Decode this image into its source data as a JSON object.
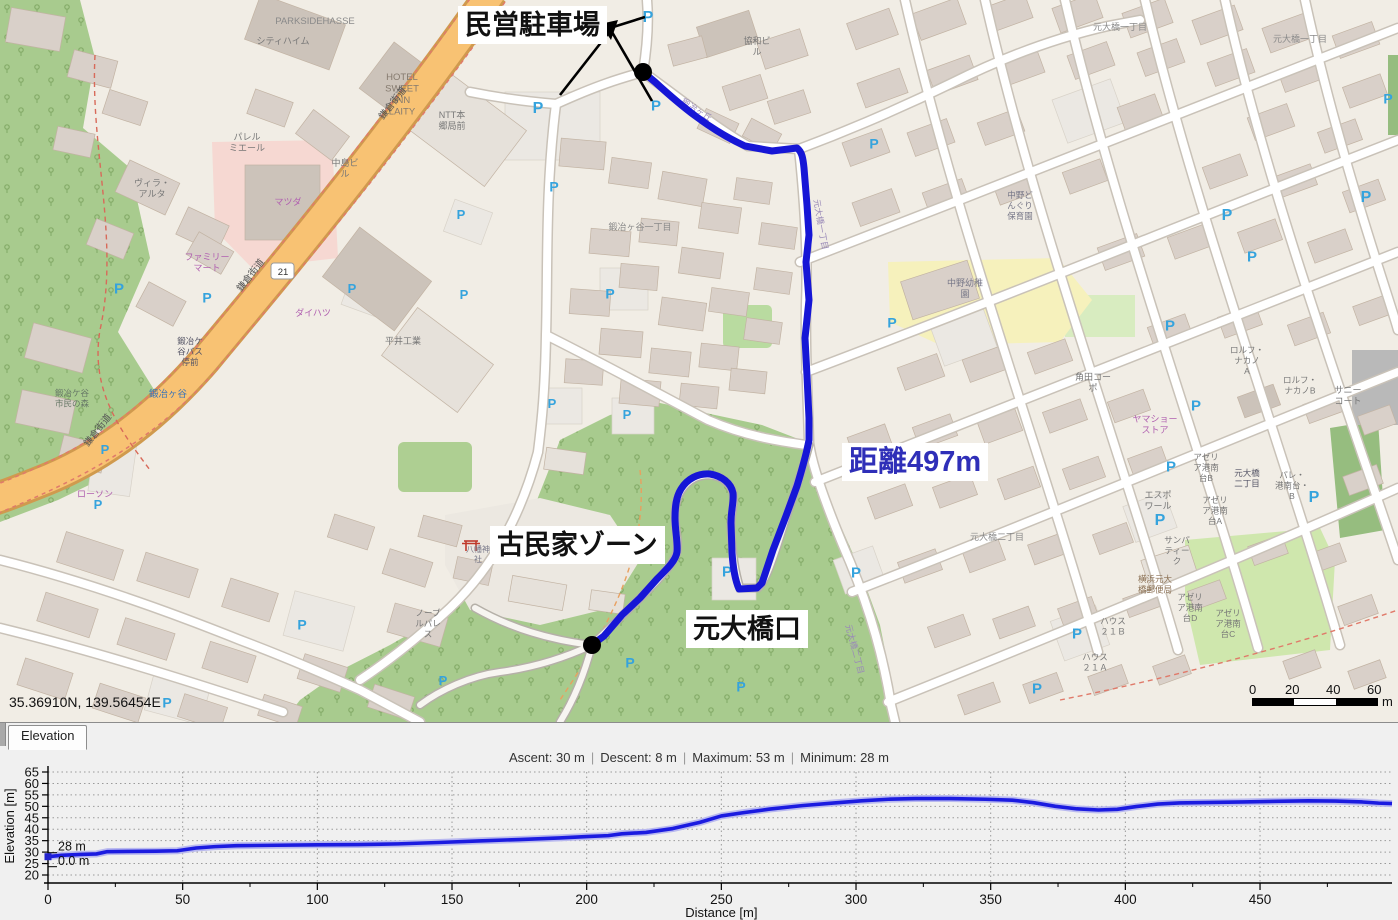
{
  "map": {
    "coordinates": "35.36910N, 139.56454E",
    "annotations": {
      "parking_label": "民営駐車場",
      "distance_label": "距離497m",
      "kominka_label": "古民家ゾーン",
      "motoohashi_label": "元大橋口"
    },
    "scale_bar": {
      "ticks": [
        "0",
        "20",
        "40",
        "60"
      ],
      "unit": "m"
    },
    "parking_symbol": "P",
    "route_number": "21",
    "colors": {
      "route": "#1616d6",
      "annotation_blue": "#2f2fb8",
      "trunk_road": "#f8c273",
      "forest": "#a8cb8e"
    },
    "labels": {
      "parkside": "PARKSIDEHASSE",
      "cityheim": "シティハイム",
      "hotel": [
        "HOTEL",
        "SWEET",
        "INN",
        "LAITY"
      ],
      "ntt": [
        "NTT本",
        "郷局前"
      ],
      "villa": [
        "ヴィラ・",
        "アルタ"
      ],
      "palermo": [
        "パレル",
        "ミエール"
      ],
      "famima": [
        "ファミリー",
        "マート"
      ],
      "lawson": "ローソン",
      "mazda": "マツダ",
      "daihatsu": "ダイハツ",
      "hirai": "平井工業",
      "nakajima": [
        "中島ビ",
        "ル"
      ],
      "kyowa": [
        "協和ビ",
        "ル"
      ],
      "kamakura": "鎌倉街道",
      "kajiya_blue": "鍛冶ヶ谷",
      "shimin_mori": [
        "鍛冶ケ谷",
        "市民の森"
      ],
      "bus_kajiya": [
        "鍛冶ケ",
        "谷バス",
        "停前"
      ],
      "kajiya1": "鍛冶ヶ谷一丁目",
      "nakano_kg": [
        "中野幼稚",
        "園"
      ],
      "nakano_hoiku": [
        "中野ど",
        "んぐり",
        "保育園"
      ],
      "kakuta": [
        "角田コー",
        "ポ"
      ],
      "rolf_a": [
        "ロルフ・",
        "ナカノ",
        "A"
      ],
      "rolf_b": [
        "ロルフ・",
        "ナカノB"
      ],
      "sunny": [
        "サニー",
        "コート"
      ],
      "yamasho": [
        "ヤマショー",
        "ストア"
      ],
      "azelia_a": [
        "アゼリ",
        "ア港南",
        "台A"
      ],
      "azelia_b": [
        "アゼリ",
        "ア港南",
        "台B"
      ],
      "azelia_c": [
        "アゼリ",
        "ア港南",
        "台C"
      ],
      "azelia_d": [
        "アゼリ",
        "ア港南",
        "台D"
      ],
      "espoir": [
        "エスポ",
        "ワール"
      ],
      "sampatique": [
        "サンパ",
        "ティー",
        "ク"
      ],
      "moto2": "元大橋二丁目",
      "moto2_bus": [
        "元大橋",
        "二丁目"
      ],
      "pale": [
        "パレ・",
        "港南台・",
        "B"
      ],
      "post": [
        "横浜元大",
        "橋郵便局"
      ],
      "house_b": [
        "ハウス",
        "２１Ｂ"
      ],
      "house_a": [
        "ハウス",
        "２１Ａ"
      ],
      "moto1": "元大橋一丁目",
      "hachiman": [
        "八幡神",
        "社"
      ],
      "noble": [
        "ノーブ",
        "ルパレ",
        "ス"
      ],
      "kajigaoka": "鍛冶ヶ丘"
    }
  },
  "elevation_panel": {
    "tab_label": "Elevation",
    "stats": {
      "ascent": "Ascent: 30 m",
      "descent": "Descent: 8 m",
      "maximum": "Maximum: 53 m",
      "minimum": "Minimum: 28 m"
    },
    "separator": "|",
    "cursor": {
      "elevation": "28 m",
      "distance": "0.0 m"
    }
  },
  "chart_data": {
    "type": "line",
    "title": "",
    "xlabel": "Distance [m]",
    "ylabel": "Elevation [m]",
    "xlim": [
      0,
      499
    ],
    "ylim": [
      20,
      65
    ],
    "grid": true,
    "legend": false,
    "xticks": [
      0,
      50,
      100,
      150,
      200,
      250,
      300,
      350,
      400,
      450
    ],
    "yticks": [
      65,
      60,
      55,
      50,
      45,
      40,
      35,
      30,
      25,
      20
    ],
    "x": [
      0,
      5,
      12,
      18,
      22,
      30,
      40,
      48,
      55,
      62,
      70,
      85,
      100,
      115,
      130,
      145,
      160,
      175,
      190,
      200,
      208,
      213,
      222,
      232,
      242,
      250,
      258,
      268,
      280,
      292,
      302,
      312,
      322,
      335,
      348,
      358,
      366,
      374,
      382,
      390,
      397,
      404,
      412,
      420,
      432,
      444,
      456,
      468,
      478,
      488,
      494,
      499
    ],
    "y": [
      28,
      28.6,
      29,
      29.2,
      30.2,
      30.3,
      30.4,
      30.6,
      31.8,
      32.4,
      32.8,
      33,
      33.2,
      33.3,
      33.6,
      34.2,
      34.9,
      35.5,
      36.2,
      36.8,
      37.2,
      38,
      38.6,
      40.3,
      43,
      45.8,
      47.2,
      48.8,
      50.3,
      51.5,
      52.4,
      53.1,
      53.4,
      53.4,
      53.1,
      52.7,
      51.6,
      50,
      48.9,
      48.4,
      48.7,
      49.9,
      51,
      51.5,
      51.7,
      51.9,
      52.2,
      52.4,
      52.3,
      51.9,
      51.4,
      51.2
    ],
    "line_color": "#1b1be0"
  }
}
